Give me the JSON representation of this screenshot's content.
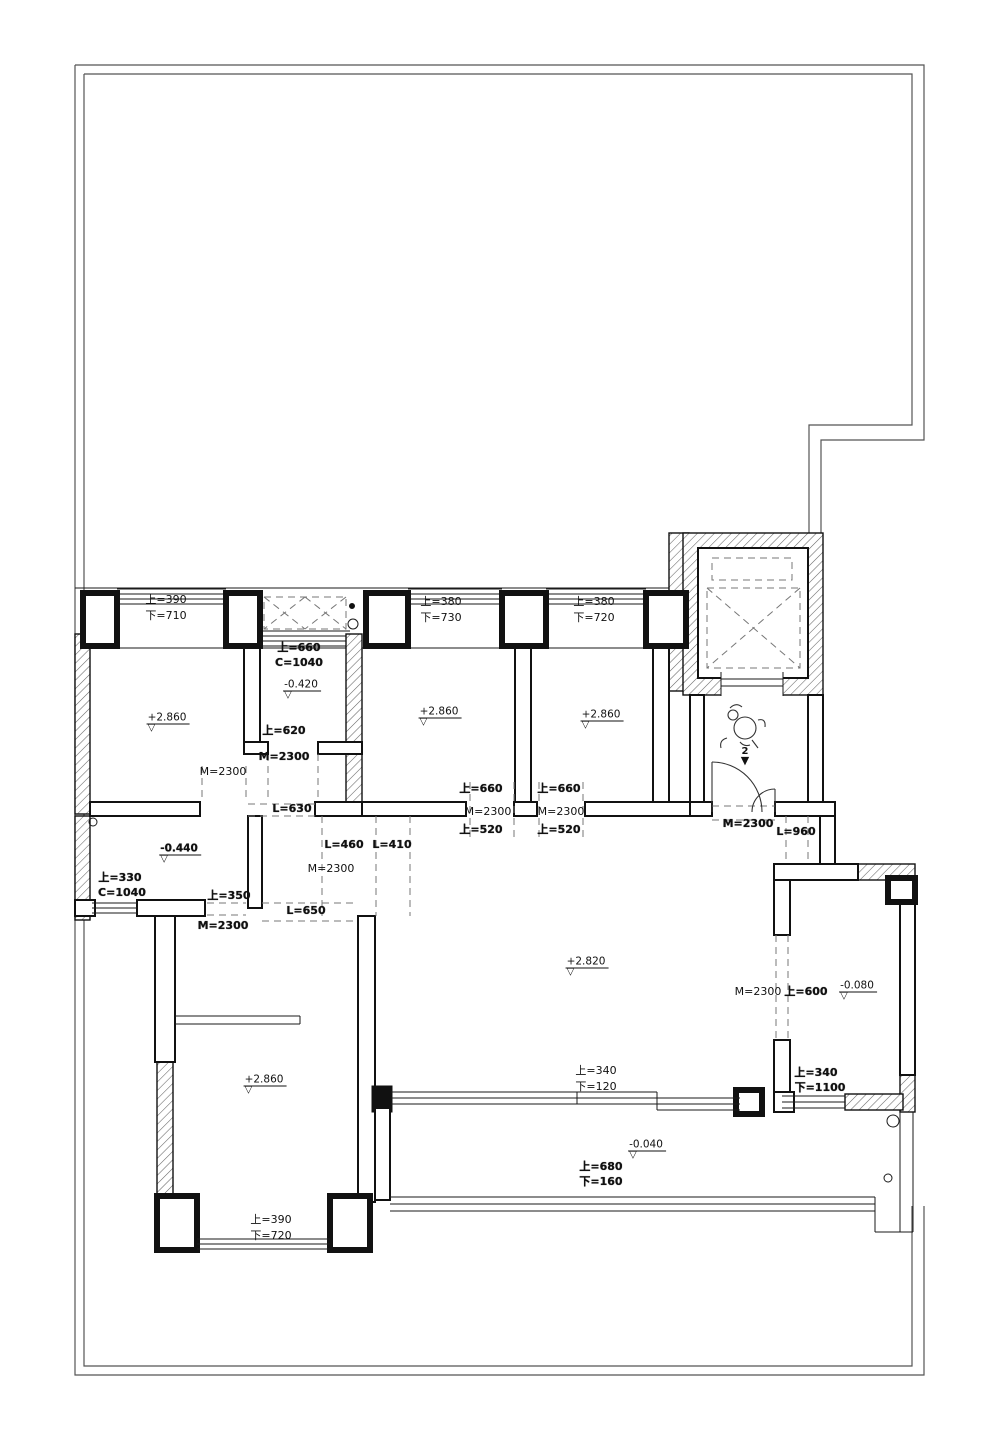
{
  "drawing": {
    "type": "residential floor plan",
    "units_note": "mm dimension annotations",
    "line_color": "#111111",
    "dash_color": "#777777",
    "paper_color": "#ffffff"
  },
  "labels": [
    {
      "t": "上=390",
      "x": 166,
      "y": 600
    },
    {
      "t": "下=710",
      "x": 166,
      "y": 616
    },
    {
      "t": "上=380",
      "x": 441,
      "y": 602
    },
    {
      "t": "下=730",
      "x": 441,
      "y": 618
    },
    {
      "t": "上=380",
      "x": 594,
      "y": 602
    },
    {
      "t": "下=720",
      "x": 594,
      "y": 618
    },
    {
      "t": "上=660",
      "x": 299,
      "y": 648,
      "b": 1
    },
    {
      "t": "C=1040",
      "x": 299,
      "y": 663,
      "b": 1
    },
    {
      "t": "上=620",
      "x": 284,
      "y": 731,
      "b": 1
    },
    {
      "t": "M=2300",
      "x": 284,
      "y": 757,
      "b": 1
    },
    {
      "t": "M=2300",
      "x": 223,
      "y": 772
    },
    {
      "t": "上=660",
      "x": 481,
      "y": 789,
      "b": 1
    },
    {
      "t": "M=2300",
      "x": 488,
      "y": 812
    },
    {
      "t": "上=520",
      "x": 481,
      "y": 830,
      "b": 1
    },
    {
      "t": "上=660",
      "x": 559,
      "y": 789,
      "b": 1
    },
    {
      "t": "M=2300",
      "x": 561,
      "y": 812
    },
    {
      "t": "上=520",
      "x": 559,
      "y": 830,
      "b": 1
    },
    {
      "t": "L=630",
      "x": 292,
      "y": 809,
      "b": 1
    },
    {
      "t": "L=460",
      "x": 344,
      "y": 845,
      "b": 1
    },
    {
      "t": "L=410",
      "x": 392,
      "y": 845,
      "b": 1
    },
    {
      "t": "M=2300",
      "x": 331,
      "y": 869
    },
    {
      "t": "M=2300",
      "x": 748,
      "y": 824,
      "b": 1
    },
    {
      "t": "L=960",
      "x": 796,
      "y": 832,
      "b": 1
    },
    {
      "t": "上=330",
      "x": 120,
      "y": 878,
      "b": 1
    },
    {
      "t": "C=1040",
      "x": 122,
      "y": 893,
      "b": 1
    },
    {
      "t": "上=350",
      "x": 229,
      "y": 896,
      "b": 1
    },
    {
      "t": "L=650",
      "x": 306,
      "y": 911,
      "b": 1
    },
    {
      "t": "M=2300",
      "x": 223,
      "y": 926,
      "b": 1
    },
    {
      "t": "M=2300",
      "x": 758,
      "y": 992
    },
    {
      "t": "上=600",
      "x": 806,
      "y": 992,
      "b": 1
    },
    {
      "t": "上=340",
      "x": 596,
      "y": 1071
    },
    {
      "t": "下=120",
      "x": 596,
      "y": 1087
    },
    {
      "t": "上=680",
      "x": 601,
      "y": 1167,
      "b": 1
    },
    {
      "t": "下=160",
      "x": 601,
      "y": 1182,
      "b": 1
    },
    {
      "t": "上=340",
      "x": 816,
      "y": 1073,
      "b": 1
    },
    {
      "t": "下=1100",
      "x": 820,
      "y": 1088,
      "b": 1
    },
    {
      "t": "上=390",
      "x": 271,
      "y": 1220
    },
    {
      "t": "下=720",
      "x": 271,
      "y": 1236
    }
  ],
  "elevations": [
    {
      "t": "+2.860",
      "x": 168,
      "y": 722
    },
    {
      "t": "-0.420",
      "x": 302,
      "y": 689
    },
    {
      "t": "+2.860",
      "x": 440,
      "y": 716
    },
    {
      "t": "+2.860",
      "x": 602,
      "y": 719
    },
    {
      "t": "-0.440",
      "x": 180,
      "y": 853,
      "b": 1
    },
    {
      "t": "+2.820",
      "x": 587,
      "y": 966
    },
    {
      "t": "-0.080",
      "x": 858,
      "y": 990
    },
    {
      "t": "+2.860",
      "x": 265,
      "y": 1084
    },
    {
      "t": "-0.040",
      "x": 647,
      "y": 1149
    }
  ],
  "symbols": {
    "elevation_triangle": "▽",
    "view_marker_number": "2",
    "view_marker_arrow": "▼"
  }
}
